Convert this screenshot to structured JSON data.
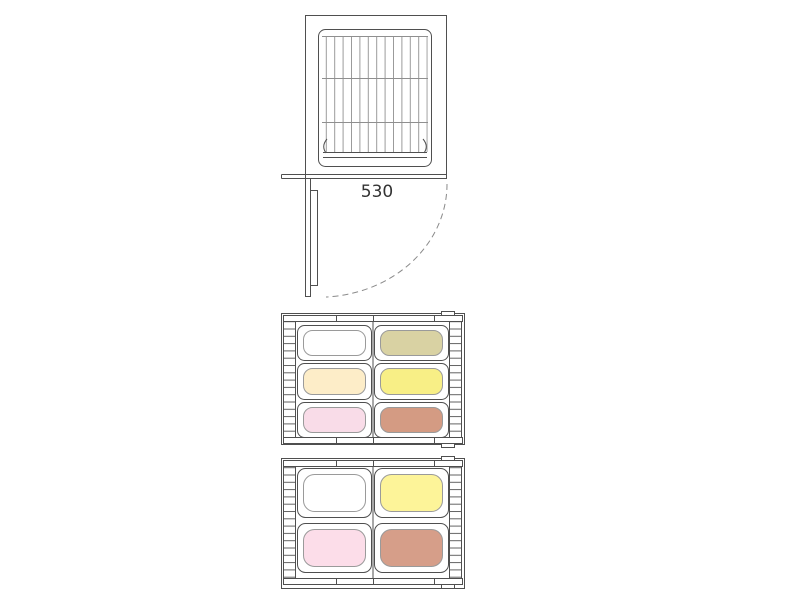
{
  "diagram": {
    "dimension_label": "530",
    "line_color": "#4f4f4f"
  },
  "trays": {
    "tray6": {
      "rows": 3,
      "cols": 2,
      "cells": [
        {
          "color": "#ffffff"
        },
        {
          "color": "#d9d2a3"
        },
        {
          "color": "#fdedc8"
        },
        {
          "color": "#f8ef86"
        },
        {
          "color": "#f9dce8"
        },
        {
          "color": "#d49b83"
        }
      ]
    },
    "tray4": {
      "rows": 2,
      "cols": 2,
      "cells": [
        {
          "color": "#ffffff"
        },
        {
          "color": "#fdf499"
        },
        {
          "color": "#fcdde9"
        },
        {
          "color": "#d69e89"
        }
      ]
    }
  }
}
